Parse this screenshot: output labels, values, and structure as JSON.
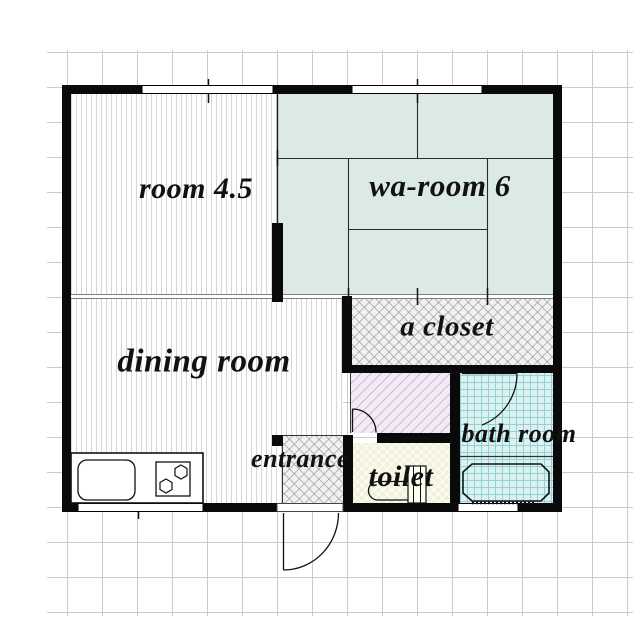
{
  "floorplan": {
    "title": "apartment floor plan",
    "rooms": [
      {
        "id": "room-4-5",
        "label": "room 4.5",
        "floor": "wood-stripes"
      },
      {
        "id": "wa-room",
        "label": "wa-room 6",
        "floor": "tatami"
      },
      {
        "id": "dining",
        "label": "dining room",
        "floor": "wood-stripes"
      },
      {
        "id": "closet",
        "label": "a closet",
        "floor": "crosshatch"
      },
      {
        "id": "entrance",
        "label": "entrance",
        "floor": "crosshatch"
      },
      {
        "id": "toilet",
        "label": "toilet",
        "floor": "yellow-hatch"
      },
      {
        "id": "bath",
        "label": "bath room",
        "floor": "cyan-tile"
      },
      {
        "id": "hallway",
        "label": "",
        "floor": "pink-diagonal"
      }
    ],
    "fixtures": [
      "kitchen-sink",
      "stove-two-burners",
      "toilet-bowl",
      "bathtub"
    ],
    "colors": {
      "wall": "#0a0a0a",
      "tatami": "#dbe9e7",
      "bath_tile": "#ddf1f1",
      "toilet_floor": "#f2f2d8",
      "hallway_floor": "#f2eaf4",
      "grid": "#cbcbcb",
      "slide_door_gray": "#7d7d7d"
    },
    "windows": {
      "top": 2,
      "bottom": 2
    },
    "doors": [
      "entrance-swing",
      "hallway-swing",
      "bath-swing"
    ]
  }
}
